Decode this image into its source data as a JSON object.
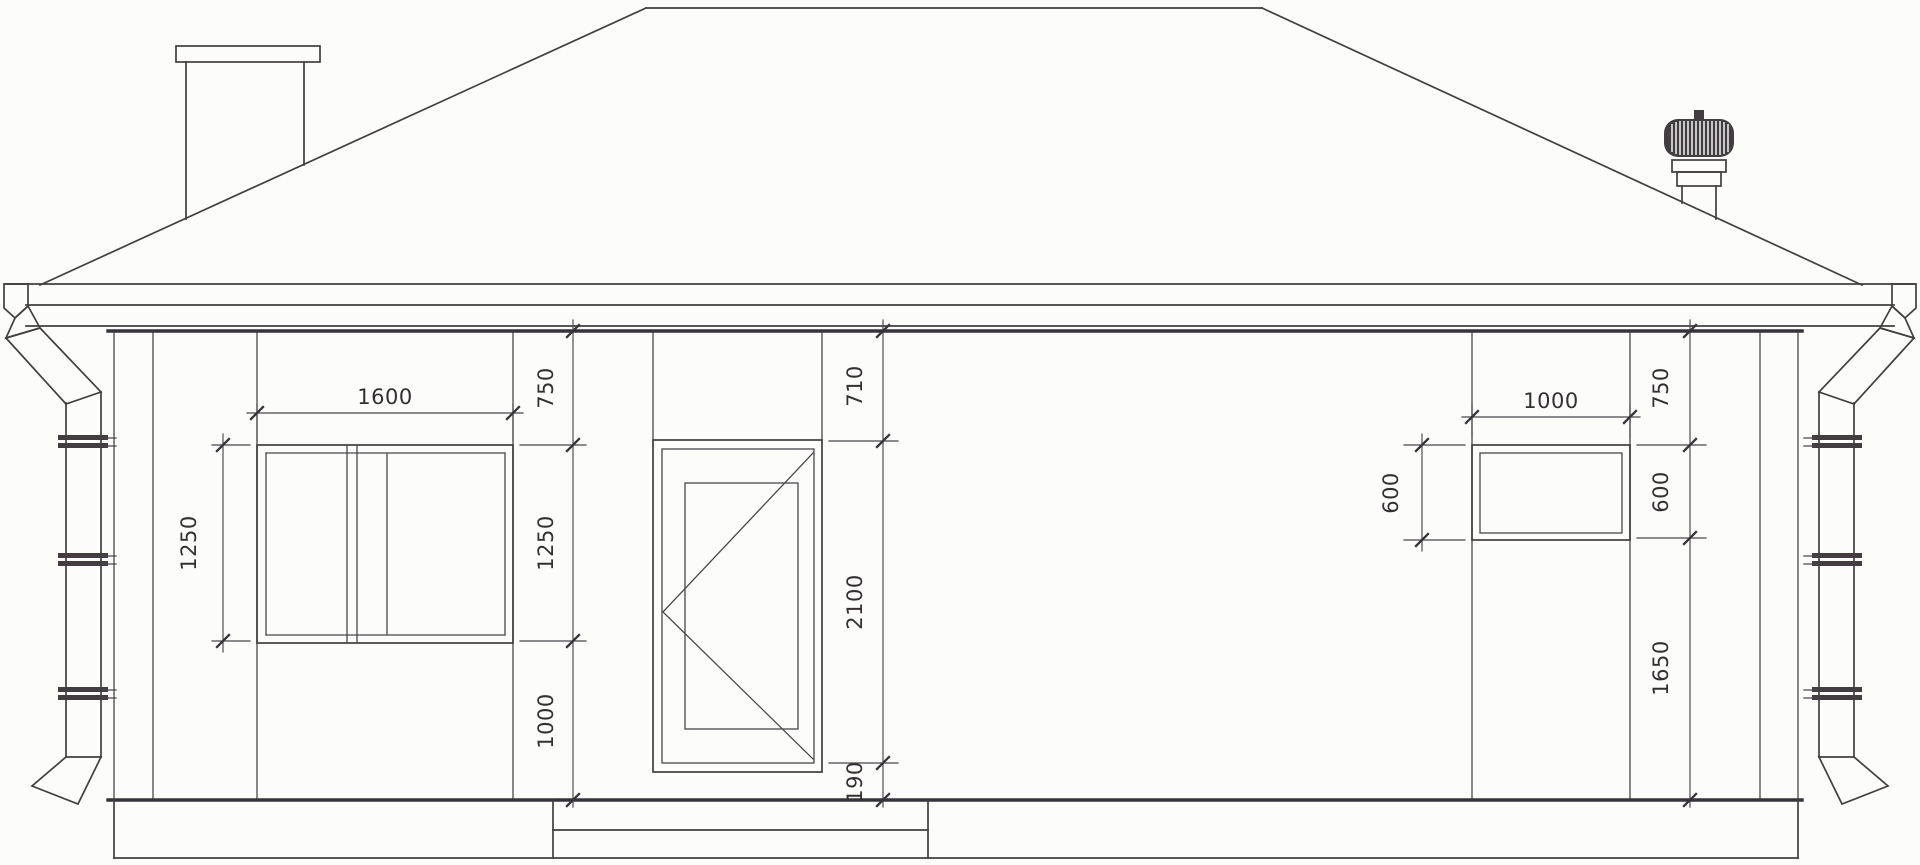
{
  "background_color": "#fcfcfb",
  "line_color": "#423e41",
  "text_color": "#332f32",
  "dims": {
    "left_window": {
      "width": "1600",
      "height": "1250",
      "chain_top": "750",
      "chain_mid": "1250",
      "chain_bottom": "1000"
    },
    "door": {
      "chain_top": "710",
      "chain_mid": "2100",
      "chain_bottom": "190"
    },
    "right_window": {
      "width": "1000",
      "height": "600",
      "chain_top": "750",
      "chain_mid": "600",
      "chain_bottom": "1650"
    }
  }
}
